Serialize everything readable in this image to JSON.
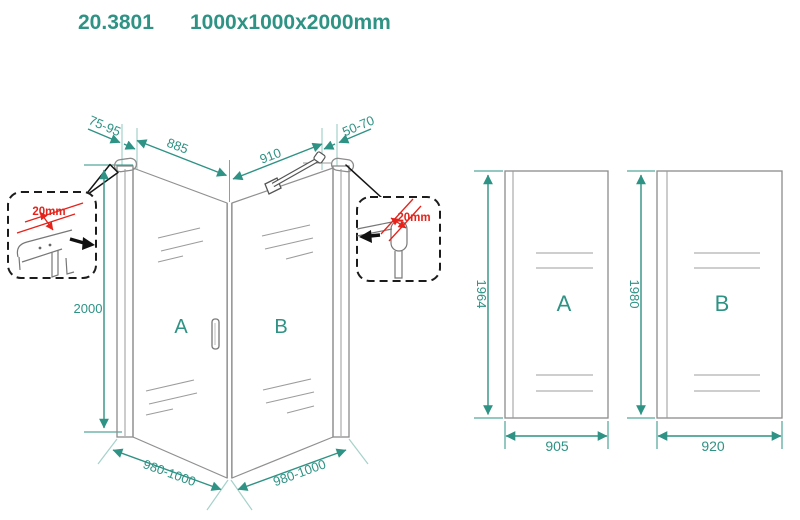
{
  "header": {
    "code": "20.3801",
    "size": "1000x1000x2000mm"
  },
  "perspective": {
    "panel_a_label": "A",
    "panel_b_label": "B",
    "dims": {
      "wall_gap_left": "75-95",
      "glass_a_width": "885",
      "glass_b_width": "910",
      "wall_gap_right": "50-70",
      "height": "2000",
      "overall_a": "980-1000",
      "overall_b": "980-1000"
    },
    "details": {
      "left_adjust": "20mm",
      "right_adjust": "20mm"
    }
  },
  "elevations": {
    "panel_a": {
      "label": "A",
      "glass_height": "1964",
      "glass_width": "905"
    },
    "panel_b": {
      "label": "B",
      "glass_height": "1980",
      "glass_width": "920"
    }
  },
  "colors": {
    "accent": "#2E9284",
    "alert": "#E5231B",
    "line": "#8C8C8C",
    "dark": "#1A1A1A"
  }
}
